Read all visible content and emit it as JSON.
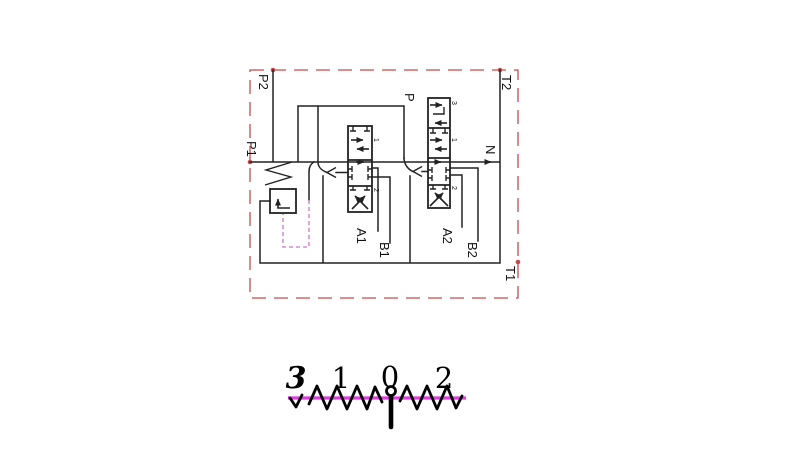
{
  "diagram": {
    "port_labels": {
      "p2": "P2",
      "p1": "P1",
      "t2": "T2",
      "n": "N",
      "t1": "T1",
      "p": "P",
      "a1": "A1",
      "b1": "B1",
      "a2": "A2",
      "b2": "B2"
    },
    "valve1_positions": {
      "top": "1",
      "bottom": "2"
    },
    "valve2_positions": {
      "float": "3",
      "top": "1",
      "bottom": "2"
    },
    "colors": {
      "line": "#222222",
      "boundary_red": "#c84b4b",
      "pilot_magenta": "#c878c8",
      "lever_magenta": "#e03ce0",
      "symbol_black": "#000000"
    }
  },
  "position_indicator": {
    "labels": [
      "3",
      "1",
      "0",
      "2"
    ]
  }
}
